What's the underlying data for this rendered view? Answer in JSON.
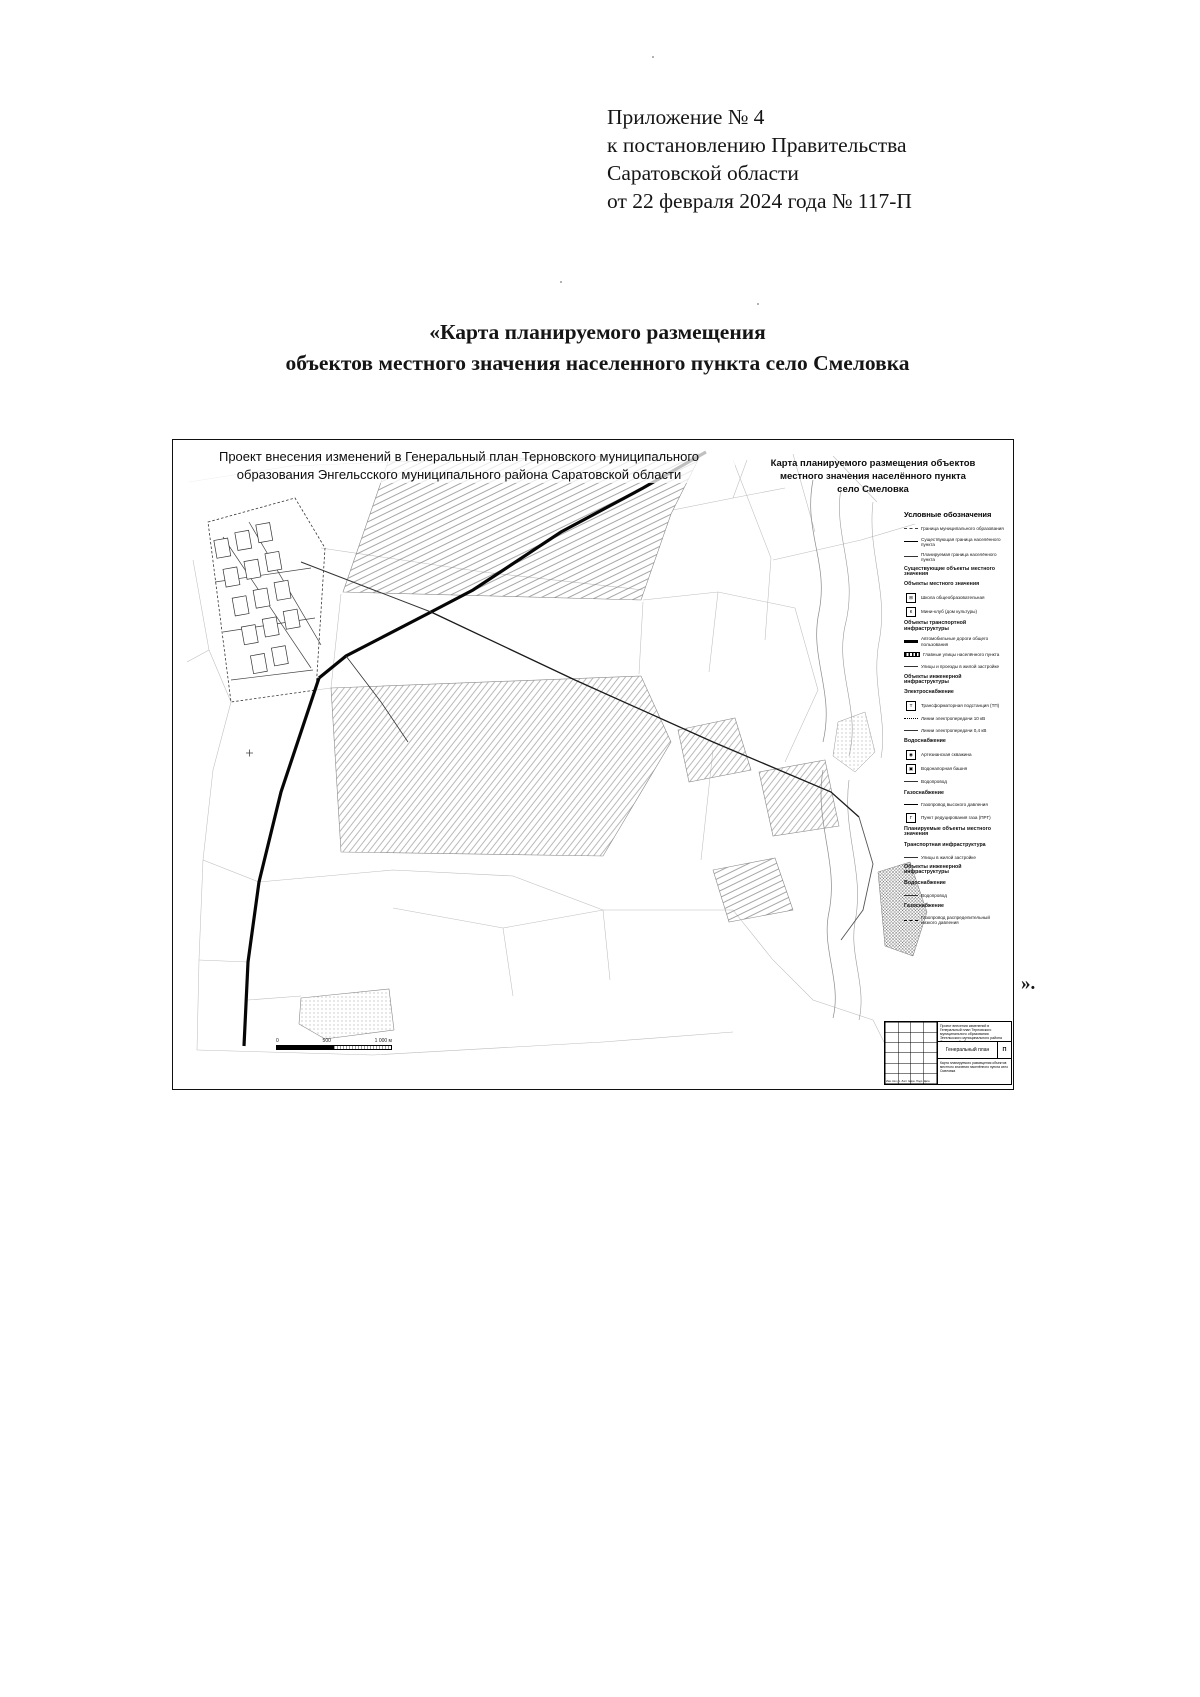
{
  "page": {
    "header_lines": [
      "Приложение № 4",
      "к постановлению Правительства",
      "Саратовской области",
      "от 22 февраля 2024 года № 117-П"
    ],
    "title_line1": "«Карта планируемого размещения",
    "title_line2": "объектов местного значения населенного пункта село Смеловка",
    "closing_mark": "»."
  },
  "map": {
    "header_left_line1": "Проект внесения изменений в Генеральный план Терновского муниципального",
    "header_left_line2": "образования Энгельсского муниципального района Саратовской области",
    "header_right_line1": "Карта планируемого размещения объектов",
    "header_right_line2": "местного значения населённого пункта",
    "header_right_line3": "село Смеловка",
    "legend": {
      "title": "Условные обозначения",
      "items": [
        {
          "sym": "dashdot",
          "label": "Граница муниципального образования"
        },
        {
          "sym": "line",
          "label": "Существующая граница населённого пункта"
        },
        {
          "sym": "thin",
          "label": "Планируемая граница населённого пункта"
        },
        {
          "sym": "none",
          "header": true,
          "label": "Существующие объекты местного значения"
        },
        {
          "sym": "none",
          "header": true,
          "label": "Объекты местного значения"
        },
        {
          "sym": "icon",
          "glyph": "⊞",
          "label": "Школа общеобразовательная"
        },
        {
          "sym": "icon",
          "glyph": "К",
          "label": "Мини-клуб (дом культуры)"
        },
        {
          "sym": "none",
          "header": true,
          "label": "Объекты транспортной инфраструктуры"
        },
        {
          "sym": "bar",
          "label": "Автомобильные дороги общего пользования"
        },
        {
          "sym": "barhatch",
          "label": "Главные улицы населённого пункта"
        },
        {
          "sym": "thin",
          "label": "Улицы и проезды в жилой застройке"
        },
        {
          "sym": "none",
          "header": true,
          "label": "Объекты инженерной инфраструктуры"
        },
        {
          "sym": "none",
          "header": true,
          "label": "Электроснабжение"
        },
        {
          "sym": "icon",
          "glyph": "Т",
          "label": "Трансформаторная подстанция (ТП)"
        },
        {
          "sym": "dotted",
          "label": "Линии электропередачи 10 кВ"
        },
        {
          "sym": "thin",
          "label": "Линии электропередачи 0,4 кВ"
        },
        {
          "sym": "none",
          "header": true,
          "label": "Водоснабжение"
        },
        {
          "sym": "icon",
          "glyph": "◉",
          "label": "Артезианская скважина"
        },
        {
          "sym": "icon",
          "glyph": "▣",
          "label": "Водонапорная башня"
        },
        {
          "sym": "thin",
          "label": "Водопровод"
        },
        {
          "sym": "none",
          "header": true,
          "label": "Газоснабжение"
        },
        {
          "sym": "line",
          "label": "Газопровод высокого давления"
        },
        {
          "sym": "icon",
          "glyph": "Г",
          "label": "Пункт редуцирования газа (ПРГ)"
        },
        {
          "sym": "none",
          "header": true,
          "label": "Планируемые объекты местного значения"
        },
        {
          "sym": "none",
          "header": true,
          "label": "Транспортная инфраструктура"
        },
        {
          "sym": "thin",
          "label": "Улицы в жилой застройке"
        },
        {
          "sym": "none",
          "header": true,
          "label": "Объекты инженерной инфраструктуры"
        },
        {
          "sym": "none",
          "header": true,
          "label": "Водоснабжение"
        },
        {
          "sym": "thin",
          "label": "Водопровод"
        },
        {
          "sym": "none",
          "header": true,
          "label": "Газоснабжение"
        },
        {
          "sym": "dash",
          "label": "Газопровод распределительный низкого давления"
        }
      ]
    },
    "scalebar": {
      "label_0": "0",
      "label_500": "500",
      "label_1000": "1 000 м"
    },
    "titleblock": {
      "columns": "Изм. Кол.уч. Лист №док. Подп. Дата",
      "project": "Проект внесения изменений в Генеральный план Терновского муниципального образования Энгельсского муниципального района Саратовской области",
      "doc_title": "Генеральный план",
      "stage": "П",
      "note": "Карта планируемого размещения объектов местного значения населённого пункта село Смеловка"
    }
  }
}
